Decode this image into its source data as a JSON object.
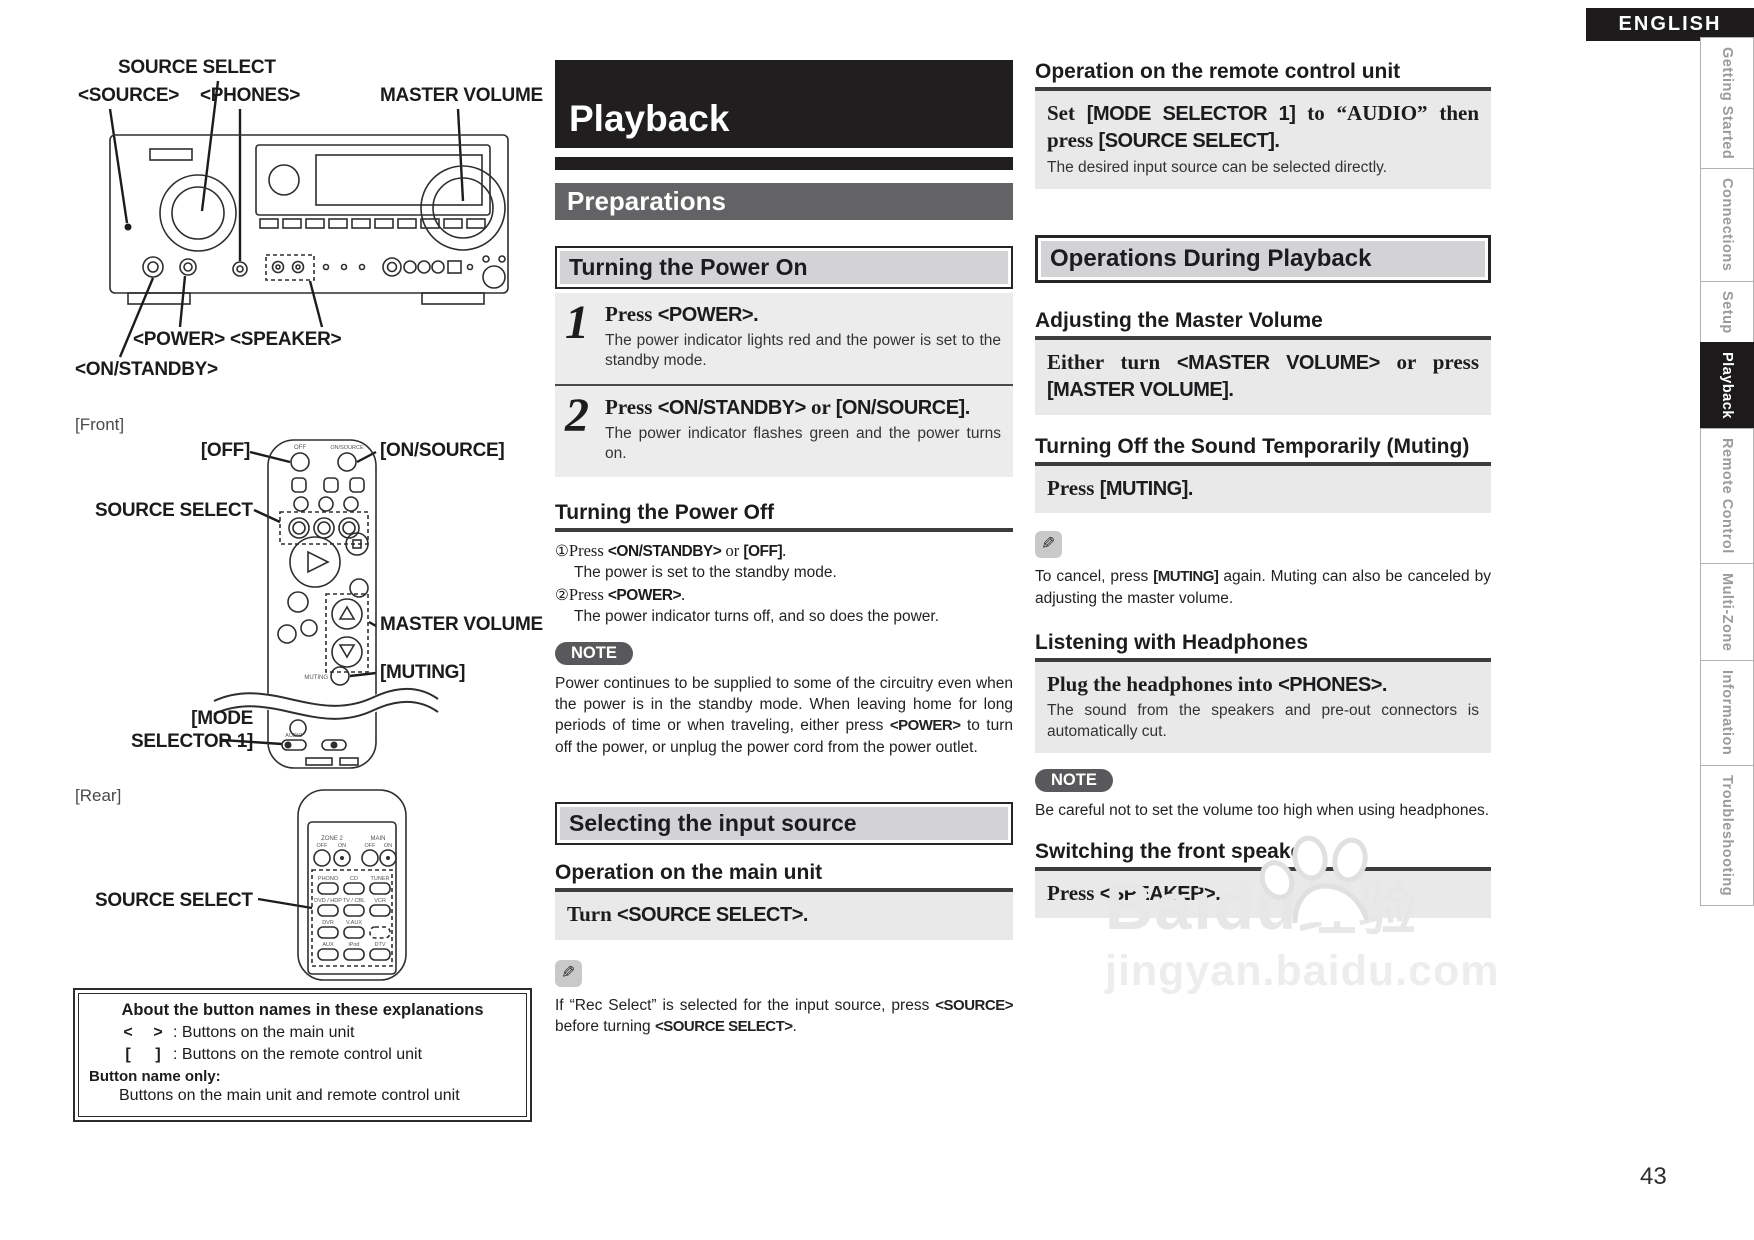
{
  "header": {
    "language": "ENGLISH"
  },
  "sidebar": {
    "tabs": [
      {
        "label": "Getting Started"
      },
      {
        "label": "Connections"
      },
      {
        "label": "Setup"
      },
      {
        "label": "Playback"
      },
      {
        "label": "Remote Control"
      },
      {
        "label": "Multi-Zone"
      },
      {
        "label": "Information"
      },
      {
        "label": "Troubleshooting"
      }
    ]
  },
  "left": {
    "panel": {
      "source_select": "SOURCE SELECT",
      "source": "<SOURCE>",
      "phones": "<PHONES>",
      "master_volume": "MASTER VOLUME",
      "power": "<POWER>",
      "speaker": "<SPEAKER>",
      "on_standby": "<ON/STANDBY>"
    },
    "front_tag": "[Front]",
    "front_remote": {
      "off": "[OFF]",
      "on_source": "[ON/SOURCE]",
      "source_select": "SOURCE SELECT",
      "master_volume": "MASTER VOLUME",
      "muting": "[MUTING]",
      "mode_line1": "[MODE",
      "mode_line2": "SELECTOR 1]",
      "cap_off": "OFF",
      "cap_on_source": "ON/SOURCE",
      "cap_muting": "MUTING",
      "cap_audio": "AUDIO"
    },
    "rear_tag": "[Rear]",
    "rear_remote": {
      "source_select": "SOURCE SELECT",
      "zone2": "ZONE 2",
      "main": "MAIN",
      "off": "OFF",
      "on": "ON",
      "labels": [
        "PHONO",
        "CD",
        "TUNER",
        "DVD / HDP",
        "TV / CBL",
        "VCR",
        "DVR",
        "V.AUX",
        "AUX",
        "iPod",
        "DTV"
      ]
    },
    "about": {
      "title": "About the button names in these explanations",
      "row1_open": "<",
      "row1_close": ">",
      "row1_desc": ": Buttons on the main unit",
      "row2_open": "[",
      "row2_close": "]",
      "row2_desc": ": Buttons on the remote control unit",
      "only_label": "Button name only:",
      "only_desc": "Buttons on the main unit and remote control unit"
    }
  },
  "middle": {
    "title": "Playback",
    "section": "Preparations",
    "power_on": {
      "title": "Turning the Power On",
      "step1": {
        "num": "1",
        "pre": "Press ",
        "b1": "<POWER>.",
        "desc": "The power indicator lights red and the power is set to the standby mode."
      },
      "step2": {
        "num": "2",
        "pre": "Press ",
        "b1": "<ON/STANDBY>",
        "mid": " or ",
        "b2": "[ON/SOURCE].",
        "desc": "The power indicator flashes green and the power turns on."
      }
    },
    "power_off": {
      "title": "Turning the Power Off",
      "i1_marker": "①",
      "i1_pre": "Press ",
      "i1_b1": "<ON/STANDBY>",
      "i1_mid": " or ",
      "i1_b2": "[OFF]",
      "i1_post": ".",
      "i1_desc": "The power is set to the standby mode.",
      "i2_marker": "②",
      "i2_pre": "Press ",
      "i2_b1": "<POWER>",
      "i2_post": ".",
      "i2_desc": "The power indicator turns off, and so does the power.",
      "note_label": "NOTE",
      "note_t1": "Power continues to be supplied to some of the circuitry even when the power is in the standby mode. When leaving home for long periods of time or when traveling, either press ",
      "note_b": "<POWER>",
      "note_t2": " to turn off the power, or unplug the power cord from the power outlet."
    },
    "input_source": {
      "title": "Selecting the input source",
      "main_unit_heading": "Operation on the main unit",
      "turn_pre": "Turn ",
      "turn_b": "<SOURCE SELECT>.",
      "tip_t1": "If “Rec Select” is selected for the input source, press ",
      "tip_b1": "<SOURCE>",
      "tip_t2": " before turning ",
      "tip_b2": "<SOURCE SELECT>",
      "tip_t3": "."
    }
  },
  "right": {
    "remote_heading": "Operation on the remote control unit",
    "set_s1": "Set ",
    "set_b1": "[MODE SELECTOR 1]",
    "set_s2": " to “AUDIO” then press ",
    "set_b2": "[SOURCE SELECT].",
    "set_sub": "The desired input source can be selected directly.",
    "ops_title": "Operations During Playback",
    "volume": {
      "heading": "Adjusting the Master Volume",
      "s1": "Either turn ",
      "b1": "<MASTER VOLUME>",
      "s2": " or press ",
      "b2": "[MASTER VOLUME]."
    },
    "muting": {
      "heading": "Turning Off the Sound Temporarily (Muting)",
      "s1": "Press ",
      "b1": "[MUTING].",
      "tip_t1": "To cancel, press ",
      "tip_b": "[MUTING]",
      "tip_t2": " again. Muting can also be canceled by adjusting the master volume."
    },
    "headphones": {
      "heading": "Listening with Headphones",
      "s1": "Plug the headphones into ",
      "b1": "<PHONES>.",
      "sub": "The sound from the speakers and pre-out connectors is automatically cut.",
      "note_label": "NOTE",
      "note": "Be careful not to set the volume too high when using headphones."
    },
    "speakers": {
      "heading": "Switching the front speakers",
      "s1": "Press ",
      "b1": "<SPEAKER>."
    }
  },
  "footer": {
    "page_number": "43"
  },
  "watermark": {
    "brand": "Baidu",
    "brand_cn": "经验",
    "url": "jingyan.baidu.com"
  }
}
